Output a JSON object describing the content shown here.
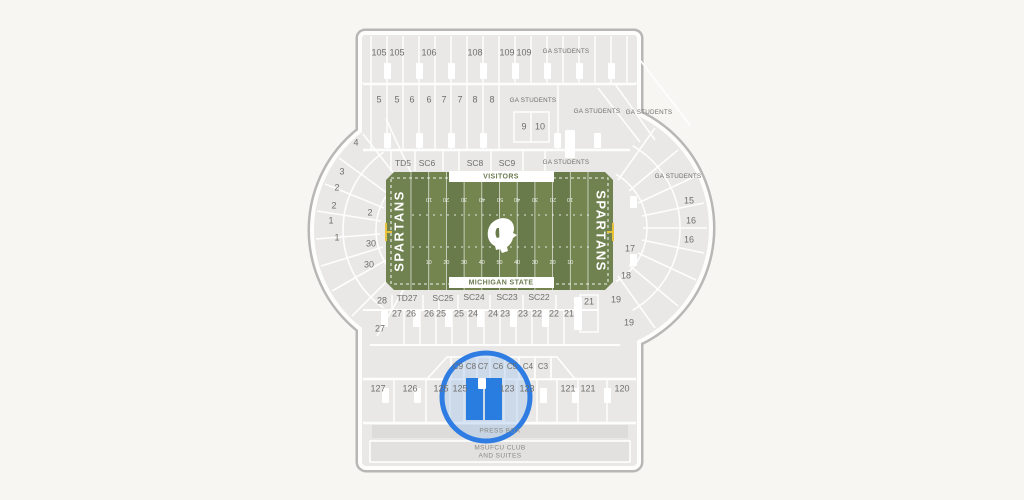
{
  "map": {
    "field": {
      "visitors_label": "VISITORS",
      "home_label": "MICHIGAN STATE",
      "endzone_text": "SPARTANS",
      "yard_numbers": [
        "10",
        "20",
        "30",
        "40",
        "50",
        "40",
        "30",
        "20",
        "10"
      ]
    },
    "section_labels": [
      "105",
      "105",
      "106",
      "108",
      "109",
      "109",
      "GA STUDENTS",
      "5",
      "5",
      "6",
      "6",
      "7",
      "7",
      "8",
      "8",
      "GA STUDENTS",
      "9",
      "10",
      "GA STUDENTS",
      "GA STUDENTS",
      "TD5",
      "SC6",
      "SC8",
      "SC9",
      "GA STUDENTS",
      "GA STUDENTS",
      "4",
      "3",
      "2",
      "2",
      "1",
      "1",
      "2",
      "30",
      "30",
      "28",
      "27",
      "15",
      "16",
      "16",
      "17",
      "18",
      "19",
      "19",
      "TD27",
      "SC25",
      "SC24",
      "SC23",
      "SC22",
      "21",
      "27",
      "26",
      "26",
      "25",
      "25",
      "24",
      "24",
      "23",
      "23",
      "22",
      "22",
      "21",
      "C9",
      "C8",
      "C7",
      "C6",
      "C5",
      "C4",
      "C3",
      "127",
      "126",
      "125",
      "125",
      "123",
      "123",
      "121",
      "121",
      "120"
    ],
    "press_box_label": "PRESS BOX",
    "suites_label_line1": "MSUFCU CLUB",
    "suites_label_line2": "AND SUITES",
    "colors": {
      "field_green": "#70824f",
      "stripe_dark": "#6a7b4b",
      "stripe_light": "#74854f",
      "selected_blue": "#2a7de0",
      "highlight_ring": "#2f7ce2",
      "section_gray": "#e9e8e6",
      "label_gray": "#6f6e6a",
      "goalpost_yellow": "#e8c23a"
    }
  }
}
